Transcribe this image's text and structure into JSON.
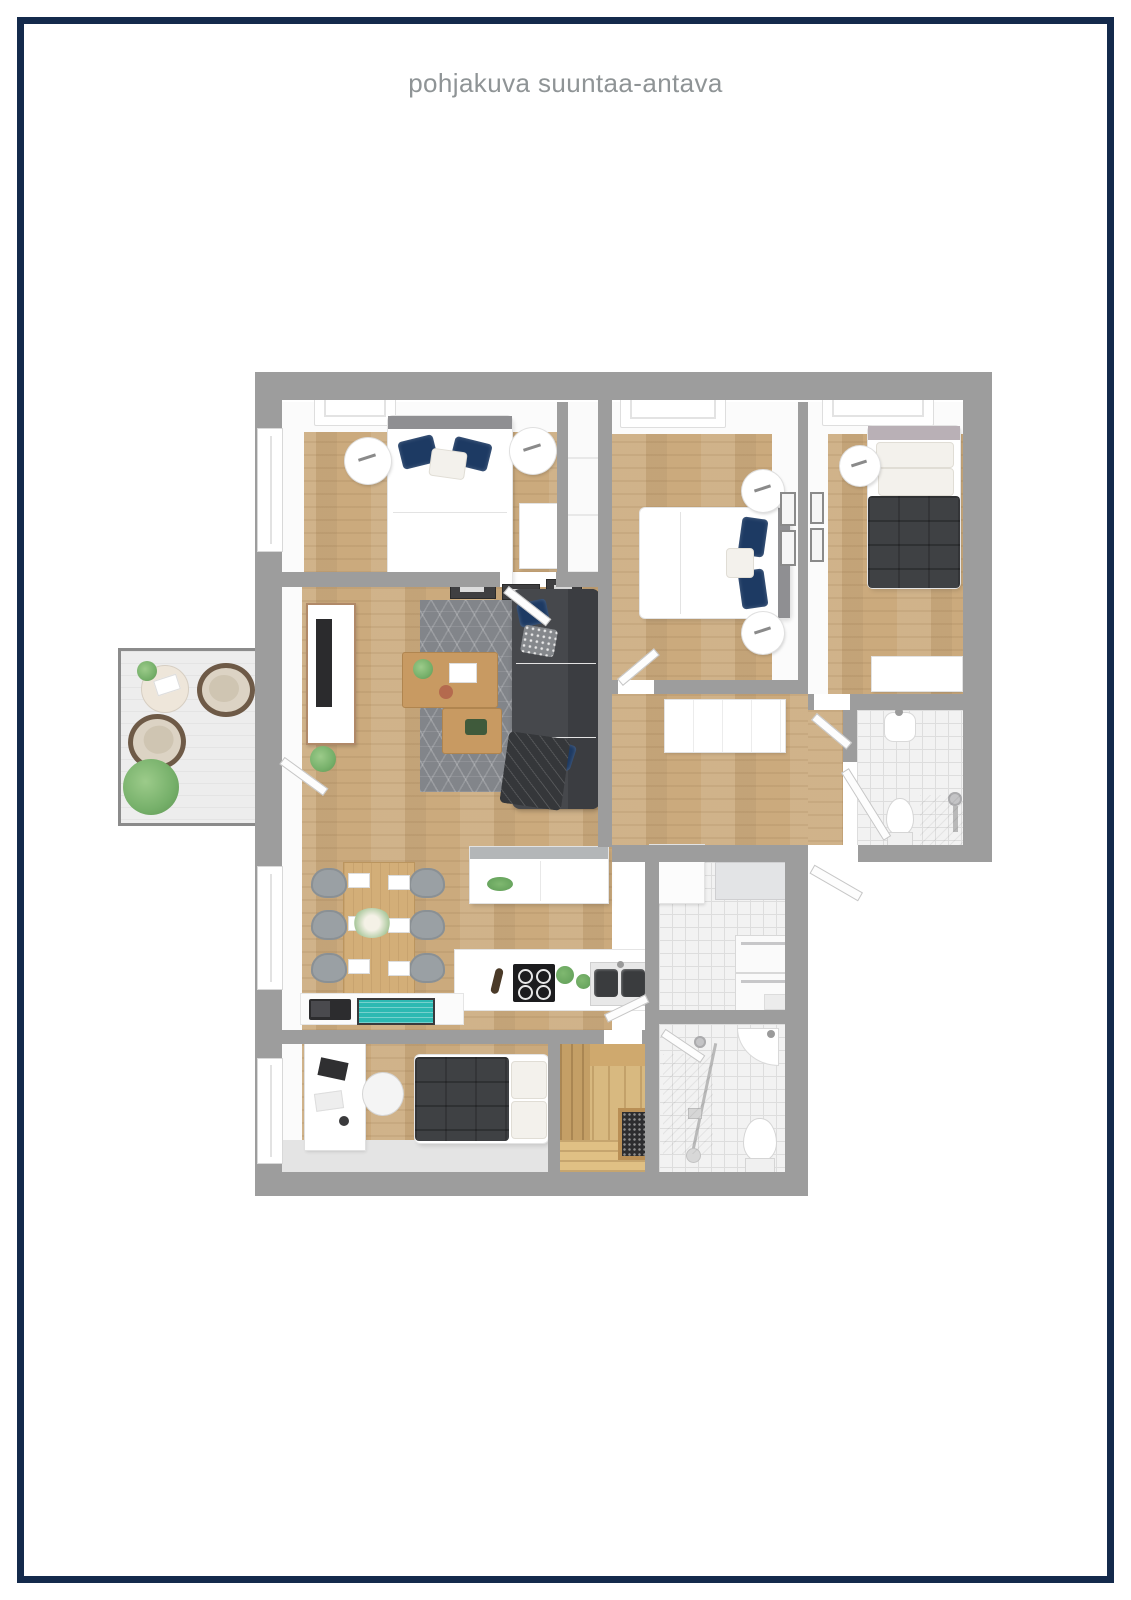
{
  "title": "pohjakuva suuntaa-antava",
  "palette": {
    "frame": "#142a4c",
    "title_text": "#8f9496",
    "wall": "#9d9d9d",
    "wood": "#cbaa7d",
    "wood_sauna": "#d8b980",
    "tile": "#f2f2f2",
    "rug": "#82858a",
    "sofa": "#46484c",
    "duvet_dark": "#3f4144",
    "pillow_navy": "#1d3a63",
    "balcony_floor": "#ededed",
    "plant_green": "#76b06a",
    "teal_accent": "#2cb9b2",
    "table_wood": "#c89a62",
    "dining_wood": "#d3ae78"
  },
  "floorplan": {
    "rooms": [
      {
        "id": "bedroom-1",
        "furniture": [
          "double-bed",
          "nightstand-left",
          "nightstand-right",
          "dresser",
          "skylight",
          "window"
        ]
      },
      {
        "id": "bedroom-2",
        "furniture": [
          "double-bed",
          "nightstand-top",
          "nightstand-bottom",
          "skylight",
          "picture-frames"
        ]
      },
      {
        "id": "bedroom-3",
        "furniture": [
          "single-bed",
          "nightstand",
          "dresser",
          "skylight",
          "picture-frames"
        ]
      },
      {
        "id": "living-room",
        "furniture": [
          "corner-sofa",
          "rug",
          "coffee-table-large",
          "coffee-table-small",
          "tv-sideboard",
          "picture-frames",
          "plant"
        ]
      },
      {
        "id": "dining-area",
        "furniture": [
          "dining-table",
          "six-chairs",
          "flower-centerpiece"
        ]
      },
      {
        "id": "kitchen",
        "furniture": [
          "island",
          "cooktop",
          "double-sink",
          "herb-pots",
          "shelf-with-laptop"
        ]
      },
      {
        "id": "hallway",
        "furniture": [
          "sideboard"
        ]
      },
      {
        "id": "bathroom",
        "furniture": [
          "sink",
          "toilet",
          "shower"
        ]
      },
      {
        "id": "utility-room",
        "furniture": [
          "wall-cabinets",
          "washer-dryer-stack",
          "tall-cabinet"
        ]
      },
      {
        "id": "shower-room",
        "furniture": [
          "corner-sink",
          "toilet",
          "shower-rail"
        ]
      },
      {
        "id": "bedroom-4",
        "furniture": [
          "desk",
          "office-chair",
          "single-bed",
          "window"
        ]
      },
      {
        "id": "sauna",
        "furniture": [
          "benches",
          "sauna-heater"
        ]
      },
      {
        "id": "balcony",
        "furniture": [
          "round-table",
          "lounge-chair",
          "lounge-chair",
          "plant"
        ]
      }
    ]
  }
}
